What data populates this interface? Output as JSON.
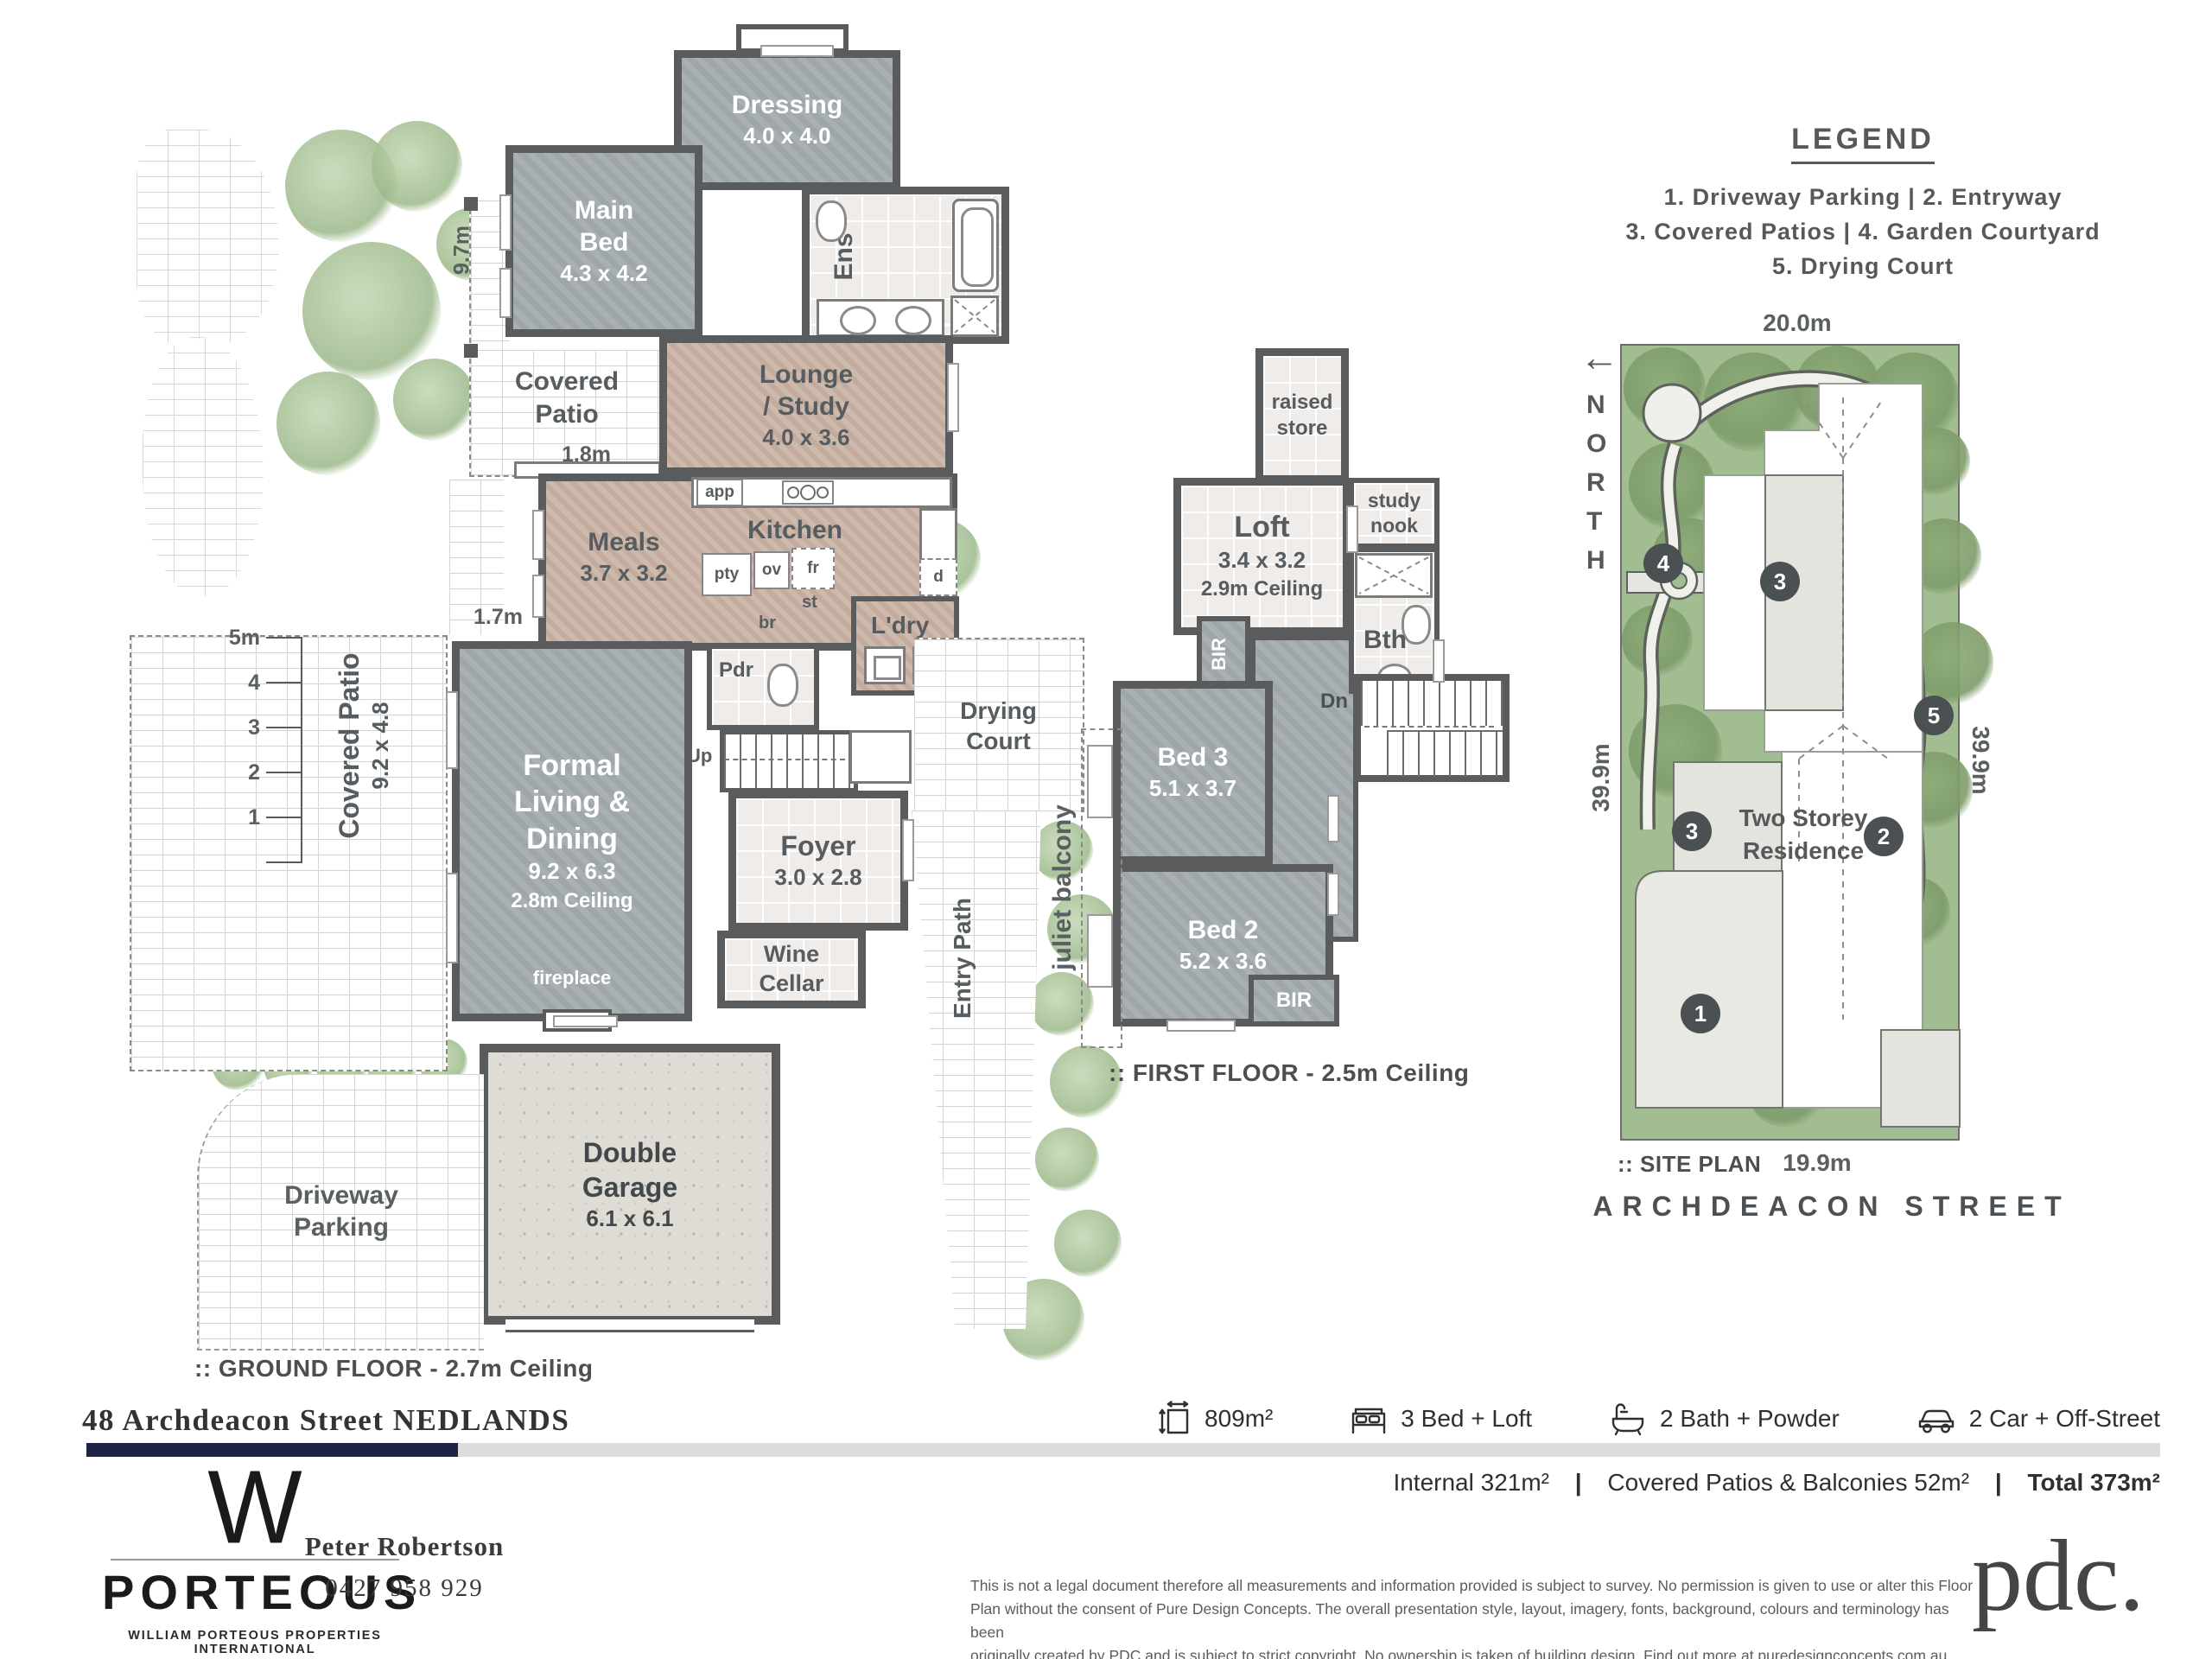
{
  "legend": {
    "title": "LEGEND",
    "line1": "1. Driveway Parking  |  2. Entryway",
    "line2": "3. Covered Patios  |   4. Garden Courtyard",
    "line3": "5. Drying Court"
  },
  "ground": {
    "caption": ":: GROUND FLOOR - 2.7m Ceiling",
    "scale": {
      "m5": "5m",
      "m4": "4",
      "m3": "3",
      "m2": "2",
      "m1": "1"
    },
    "rooms": {
      "dressing": {
        "name": "Dressing",
        "dim": "4.0 x 4.0"
      },
      "main_bed": {
        "name": "Main Bed",
        "dim": "4.3 x 4.2"
      },
      "ens": {
        "name": "Ens"
      },
      "lounge": {
        "l1": "Lounge",
        "l2": "/ Study",
        "dim": "4.0 x 3.6"
      },
      "patio_top": {
        "name": "Covered Patio",
        "dim_w": "1.8m",
        "dim_h": "9.7m"
      },
      "meals": {
        "name": "Meals",
        "dim": "3.7 x 3.2"
      },
      "kitchen": {
        "name": "Kitchen"
      },
      "ldry": {
        "name": "L'dry"
      },
      "pdr": {
        "name": "Pdr"
      },
      "up": {
        "name": "Up"
      },
      "formal": {
        "l1": "Formal",
        "l2": "Living &",
        "l3": "Dining",
        "dim": "9.2 x 6.3",
        "ceiling": "2.8m Ceiling",
        "fireplace": "fireplace"
      },
      "patio_left": {
        "name": "Covered Patio",
        "dim": "9.2 x 4.8"
      },
      "foyer": {
        "name": "Foyer",
        "dim": "3.0 x 2.8"
      },
      "wine": {
        "l1": "Wine",
        "l2": "Cellar"
      },
      "drying": {
        "l1": "Drying",
        "l2": "Court"
      },
      "entry_path": {
        "name": "Entry Path"
      },
      "garage": {
        "l1": "Double",
        "l2": "Garage",
        "dim": "6.1 x 6.1"
      },
      "driveway": {
        "l1": "Driveway",
        "l2": "Parking"
      }
    },
    "fixtures": {
      "app": "app",
      "ov": "ov",
      "fr": "fr",
      "st": "st",
      "pty": "pty",
      "br": "br",
      "w": "w",
      "d": "d",
      "dim17": "1.7m"
    }
  },
  "first": {
    "caption": ":: FIRST FLOOR - 2.5m Ceiling",
    "rooms": {
      "raised_store": {
        "l1": "raised",
        "l2": "store"
      },
      "loft": {
        "name": "Loft",
        "dim": "3.4 x 3.2",
        "ceiling": "2.9m Ceiling"
      },
      "study": {
        "l1": "study",
        "l2": "nook"
      },
      "bth": {
        "name": "Bth"
      },
      "bir_top": {
        "name": "BIR"
      },
      "bir_bottom": {
        "name": "BIR"
      },
      "dn": {
        "name": "Dn"
      },
      "bed3": {
        "name": "Bed 3",
        "dim": "5.1 x 3.7"
      },
      "bed2": {
        "name": "Bed 2",
        "dim": "5.2 x 3.6"
      },
      "juliet": {
        "name": "juliet balcony"
      }
    }
  },
  "site": {
    "caption": ":: SITE PLAN",
    "street": "ARCHDEACON STREET",
    "north": "NORTH",
    "north_arrow": "←",
    "residence_l1": "Two Storey",
    "residence_l2": "Residence",
    "dims": {
      "top": "20.0m",
      "left": "39.9m",
      "right": "39.9m",
      "bottom": "19.9m"
    },
    "markers": {
      "m1": "1",
      "m2": "2",
      "m3a": "3",
      "m3b": "3",
      "m4": "4",
      "m5": "5"
    }
  },
  "footer": {
    "address": "48 Archdeacon Street NEDLANDS",
    "stats": {
      "area": "809m²",
      "beds": "3 Bed + Loft",
      "baths": "2 Bath + Powder",
      "cars": "2 Car + Off-Street"
    },
    "totals": {
      "internal": "Internal 321m²",
      "sep": "|",
      "patios": "Covered Patios & Balconies 52m²",
      "total": "Total 373m²"
    },
    "brand": {
      "w": "W",
      "name": "PORTEOUS",
      "tagline": "WILLIAM PORTEOUS PROPERTIES INTERNATIONAL"
    },
    "agent": {
      "name": "Peter Robertson",
      "phone": "0427 958 929"
    },
    "disclaimer": {
      "l1": "This is not a legal document therefore all measurements and information provided is subject to survey. No permission is given to use or alter this Floor",
      "l2": "Plan without the consent of Pure Design Concepts. The overall presentation style, layout, imagery, fonts, background, colours and terminology has been",
      "l3": "originally created by PDC and is subject to strict copyright. No ownership is taken of building design. Find out more at puredesignconcepts.com.au"
    },
    "pdc": "pdc."
  }
}
